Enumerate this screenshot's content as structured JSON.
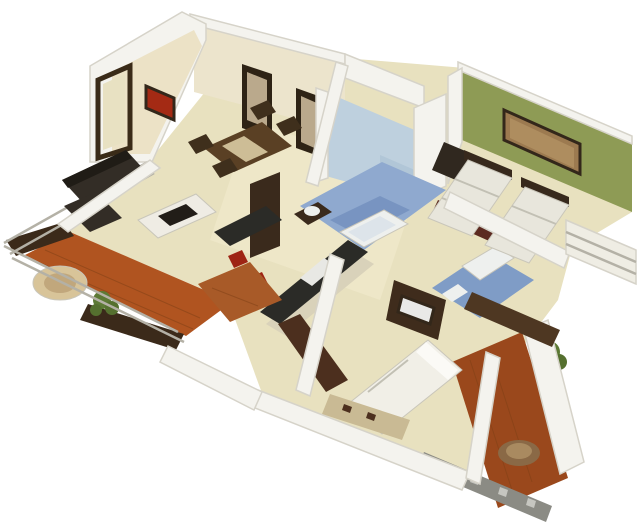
{
  "image": {
    "description": "3D isometric render of a two-bedroom apartment floor plan viewed from above on a plain white background",
    "type": "3d-isometric-floor-plan",
    "background": "#ffffff"
  },
  "rooms": [
    "entrance-foyer",
    "dining-area",
    "living-room",
    "kitchen",
    "hallway",
    "bathroom-1",
    "kids-bedroom",
    "bathroom-2",
    "master-bedroom",
    "balcony-left",
    "balcony-right"
  ],
  "objects": [
    "sectional-sofa",
    "coffee-table",
    "dining-table-with-chairs",
    "tall-display-units",
    "kitchen-island-with-sink",
    "kitchen-counter",
    "tall-kitchen-cabinet",
    "red-bar-stools",
    "bathtub",
    "vanity-sink",
    "twin-beds",
    "double-bed",
    "bed-bench",
    "tv-cabinet",
    "wardrobe-dresser",
    "wall-painting",
    "red-wall-art",
    "entrance-door",
    "wooden-deck",
    "planter-boxes",
    "potted-plants",
    "round-rug",
    "round-table",
    "glass-railing",
    "checkered-parapet",
    "maroon-rug"
  ],
  "palette": {
    "bg": "#ffffff",
    "floor": "#e8e1bf",
    "floorLight": "#f2ecd0",
    "wallWhite": "#f4f3ee",
    "creamWall": "#ece4cc",
    "foyerWall": "#ece2c6",
    "redArt": "#a42a14",
    "doorFloor": "#e8e1c2",
    "tallUnit": "#2e2315",
    "unitPanel": "#baa98c",
    "greenWall": "#8e9b55",
    "painting": "#9c7a50",
    "paintingInner": "#b29062",
    "blueWall": "#bed0de",
    "blueWallShade": "#a9bfd2",
    "blueFloor1": "#8fa9cf",
    "blueFloorShade": "#6d8cba",
    "blueFloor2": "#7f9cc6",
    "fixture": "#eef0ee",
    "fixtureShade": "#dde4ea",
    "deckLeft": "#b05420",
    "deckRight": "#9a481c",
    "planter": "#3b2a1a",
    "rugRound": "#d8c499",
    "plantGreen": "#5d7a35",
    "plantGreen2": "#55702f",
    "railLight": "#efede4",
    "parapet": "#8b8b84",
    "parapetLight": "#c6c6c0",
    "sideTable": "#8a6946",
    "sideTableTop": "#a98a60",
    "sofaDark": "#332d26",
    "sofaDarker": "#201c16",
    "coffeeWhite": "#efece4",
    "tray": "#221d18",
    "tableWood": "#5a4024",
    "runner": "#cdbd96",
    "chairDark": "#3f2f1c",
    "counterTop": "#2b2b27",
    "counterBase": "#d9d2ba",
    "tallCabinet": "#3a2a1c",
    "sinkWhite": "#e8e8e4",
    "stoolRed": "#9e2414",
    "thresholdWood": "#a85a28",
    "maroonRug": "#5c2a20",
    "bedKids": "#e8e6dc",
    "headboard": "#37291c",
    "deskDark": "#30281f",
    "dresser": "#4e3722",
    "bedMaster": "#f1efe7",
    "pillow": "#fbfaf6",
    "bench": "#c9ba94",
    "tvCabinet": "#3f2c1c",
    "tvScreen": "#e9e9e7",
    "sideboard": "#4c2f1e"
  }
}
